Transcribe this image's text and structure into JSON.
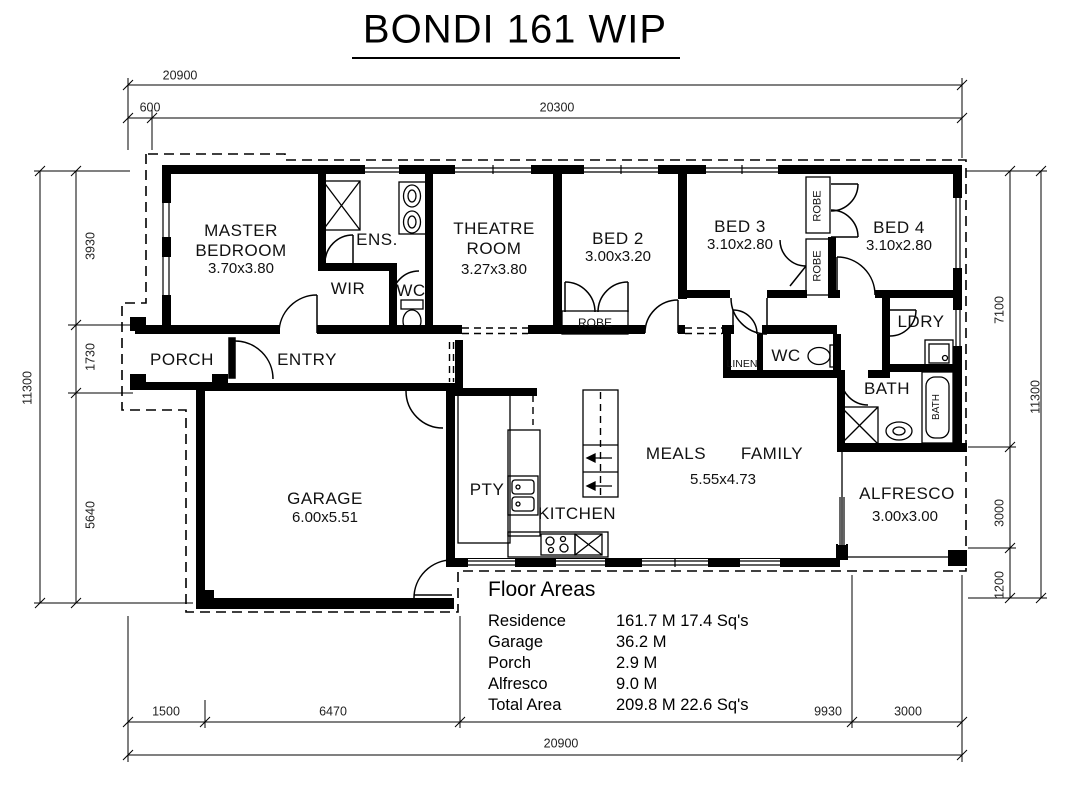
{
  "title": "BONDI 161 WIP",
  "colors": {
    "line": "#000000",
    "background": "#ffffff"
  },
  "rooms": {
    "master": {
      "name": "MASTER BEDROOM",
      "size": "3.70x3.80"
    },
    "ens": {
      "name": "ENS."
    },
    "wir": {
      "name": "WIR"
    },
    "wc1": {
      "name": "WC"
    },
    "theatre": {
      "name": "THEATRE ROOM",
      "size": "3.27x3.80"
    },
    "bed2": {
      "name": "BED 2",
      "size": "3.00x3.20"
    },
    "bed3": {
      "name": "BED 3",
      "size": "3.10x2.80"
    },
    "bed4": {
      "name": "BED 4",
      "size": "3.10x2.80"
    },
    "robe_bed2": "ROBE",
    "robe_bed3": "ROBE",
    "robe_bed4": "ROBE",
    "ldry": {
      "name": "LDRY"
    },
    "linen": {
      "name": "LINEN"
    },
    "wc2": {
      "name": "WC"
    },
    "bath": {
      "name": "BATH"
    },
    "bath_tub": "BATH",
    "porch": {
      "name": "PORCH"
    },
    "entry": {
      "name": "ENTRY"
    },
    "garage": {
      "name": "GARAGE",
      "size": "6.00x5.51"
    },
    "pty": {
      "name": "PTY"
    },
    "kitchen": {
      "name": "KITCHEN"
    },
    "meals": {
      "name": "MEALS"
    },
    "family": {
      "name": "FAMILY"
    },
    "meals_family_size": "5.55x4.73",
    "alfresco": {
      "name": "ALFRESCO",
      "size": "3.00x3.00"
    }
  },
  "dimensions": {
    "top": {
      "overall": "20900",
      "offset": "600",
      "main": "20300"
    },
    "bottom": {
      "segs": [
        "1500",
        "6470",
        "9930",
        "3000"
      ],
      "overall": "20900"
    },
    "left": {
      "segs": [
        "3930",
        "1730",
        "5640"
      ],
      "overall": "11300"
    },
    "right": {
      "segs": [
        "7100",
        "3000",
        "1200"
      ],
      "overall": "11300"
    }
  },
  "floor_areas": {
    "title": "Floor Areas",
    "rows": [
      {
        "label": "Residence",
        "value": "161.7 M 17.4 Sq's"
      },
      {
        "label": "Garage",
        "value": "36.2 M"
      },
      {
        "label": "Porch",
        "value": "2.9 M"
      },
      {
        "label": "Alfresco",
        "value": "9.0 M"
      },
      {
        "label": "Total Area",
        "value": "209.8 M 22.6 Sq's"
      }
    ]
  }
}
